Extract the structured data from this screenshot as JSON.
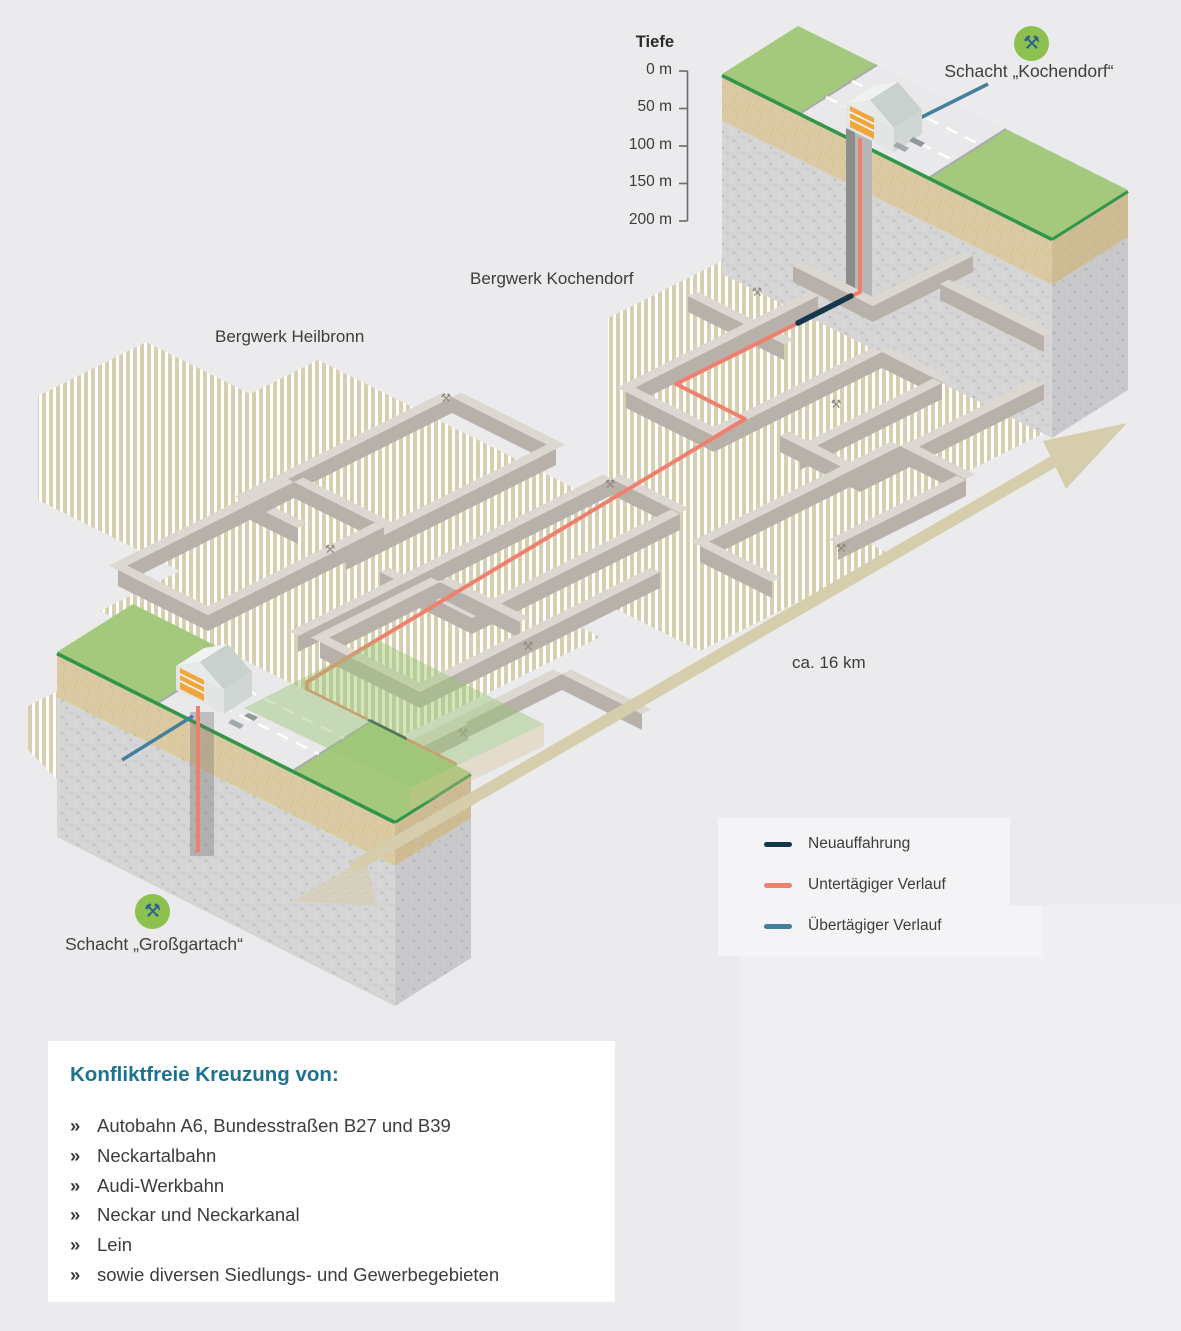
{
  "depth_scale": {
    "title": "Tiefe",
    "ticks": [
      "0 m",
      "50 m",
      "100 m",
      "150 m",
      "200 m"
    ]
  },
  "labels": {
    "mine_kochendorf": "Bergwerk Kochendorf",
    "mine_heilbronn": "Bergwerk Heilbronn",
    "shaft_kochendorf": "Schacht „Kochendorf“",
    "shaft_grossgartach": "Schacht „Großgartach“",
    "distance": "ca. 16 km"
  },
  "legend": {
    "items": [
      {
        "label": "Neuauffahrung",
        "color": "#16384c"
      },
      {
        "label": "Untertägiger Verlauf",
        "color": "#f0806e"
      },
      {
        "label": "Übertägiger Verlauf",
        "color": "#44809c"
      }
    ]
  },
  "info_box": {
    "heading": "Konfliktfreie Kreuzung von:",
    "bullet": "»",
    "items": [
      "Autobahn A6, Bundesstraßen B27 und B39",
      "Neckartalbahn",
      "Audi-Werkbahn",
      "Neckar und Neckarkanal",
      "Lein",
      "sowie diversen Siedlungs- und Gewerbegebieten"
    ]
  },
  "icons": {
    "shaft_symbol": "⚒",
    "shaft_symbol_name": "crossed-hammers-icon",
    "icon_bg": "#8cc04f",
    "icon_fg": "#2b5f8e"
  },
  "colors": {
    "background": "#ebebed",
    "route_new": "#16384c",
    "route_underground": "#f0806e",
    "route_surface": "#44809c",
    "grass": "#a5c97c",
    "grass_edge": "#2f9747",
    "soil": "#dbc9a2",
    "rock": "#d5d5d6",
    "mine_stripe": "#d6d0b0",
    "wall_top": "#dcd7d0",
    "wall_side": "#b7b1aa",
    "arrow": "#d5cdab",
    "heading_teal": "#1b7291"
  }
}
